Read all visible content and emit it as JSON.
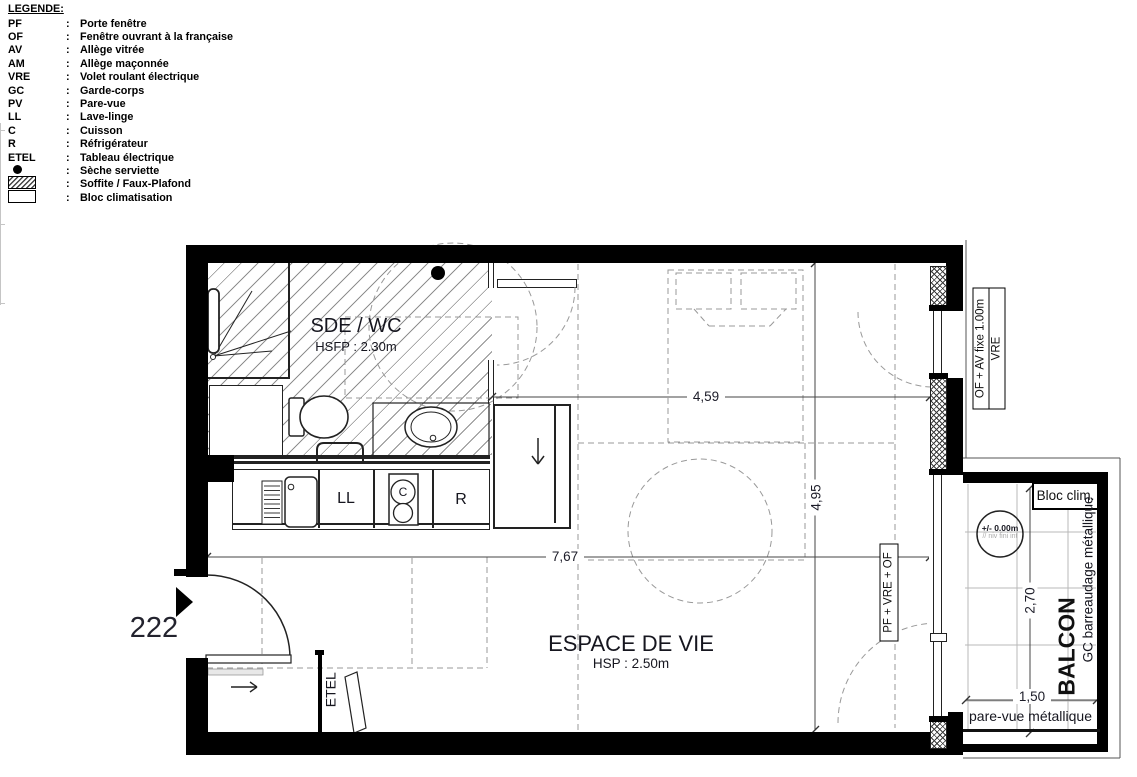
{
  "legend": {
    "title": "LEGENDE:",
    "colon": ":",
    "items": [
      {
        "symbol": "PF",
        "label": "Porte fenêtre"
      },
      {
        "symbol": "OF",
        "label": "Fenêtre ouvrant à la française"
      },
      {
        "symbol": "AV",
        "label": "Allège vitrée"
      },
      {
        "symbol": "AM",
        "label": "Allège maçonnée"
      },
      {
        "symbol": "VRE",
        "label": "Volet roulant électrique"
      },
      {
        "symbol": "GC",
        "label": "Garde-corps"
      },
      {
        "symbol": "PV",
        "label": "Pare-vue"
      },
      {
        "symbol": "LL",
        "label": "Lave-linge"
      },
      {
        "symbol": "C",
        "label": "Cuisson"
      },
      {
        "symbol": "R",
        "label": "Réfrigérateur"
      },
      {
        "symbol": "ETEL",
        "label": "Tableau électrique"
      },
      {
        "symbol": "●",
        "label": "Sèche serviette",
        "icon": "dot-icon"
      },
      {
        "symbol": "hatch-box",
        "label": "Soffite / Faux-Plafond",
        "icon": "hatch-box-icon"
      },
      {
        "symbol": "white-box",
        "label": "Bloc climatisation",
        "icon": "white-box-icon"
      }
    ]
  },
  "unit": {
    "number": "222"
  },
  "rooms": {
    "bathroom": {
      "name": "SDE / WC",
      "ceiling": "HSFP : 2.30m"
    },
    "living": {
      "name": "ESPACE DE VIE",
      "ceiling": "HSP : 2.50m"
    },
    "balcony": {
      "name": "BALCON",
      "railing": "GC barreaudage métallique",
      "screen": "pare-vue métallique",
      "ac_unit": "Bloc clim.",
      "level": "+/- 0.00m",
      "level_note": "// niv fini int"
    }
  },
  "fixtures": {
    "washer": "LL",
    "cooktop": "C",
    "fridge": "R",
    "electrical_panel": "ETEL"
  },
  "windows": {
    "top_right_window": {
      "line1": "OF + AV fixe 1.00m",
      "line2": "VRE"
    },
    "balcony_door": "PF + VRE + OF"
  },
  "dimensions": {
    "living_width": "4,59",
    "living_depth": "4,95",
    "total_width": "7,67",
    "balcony_width": "2,70",
    "balcony_depth": "1,50"
  },
  "colors": {
    "wall": "#000000",
    "hatch": "#8f8f8f",
    "dashed": "#999999",
    "grid": "#b8b8b8"
  }
}
